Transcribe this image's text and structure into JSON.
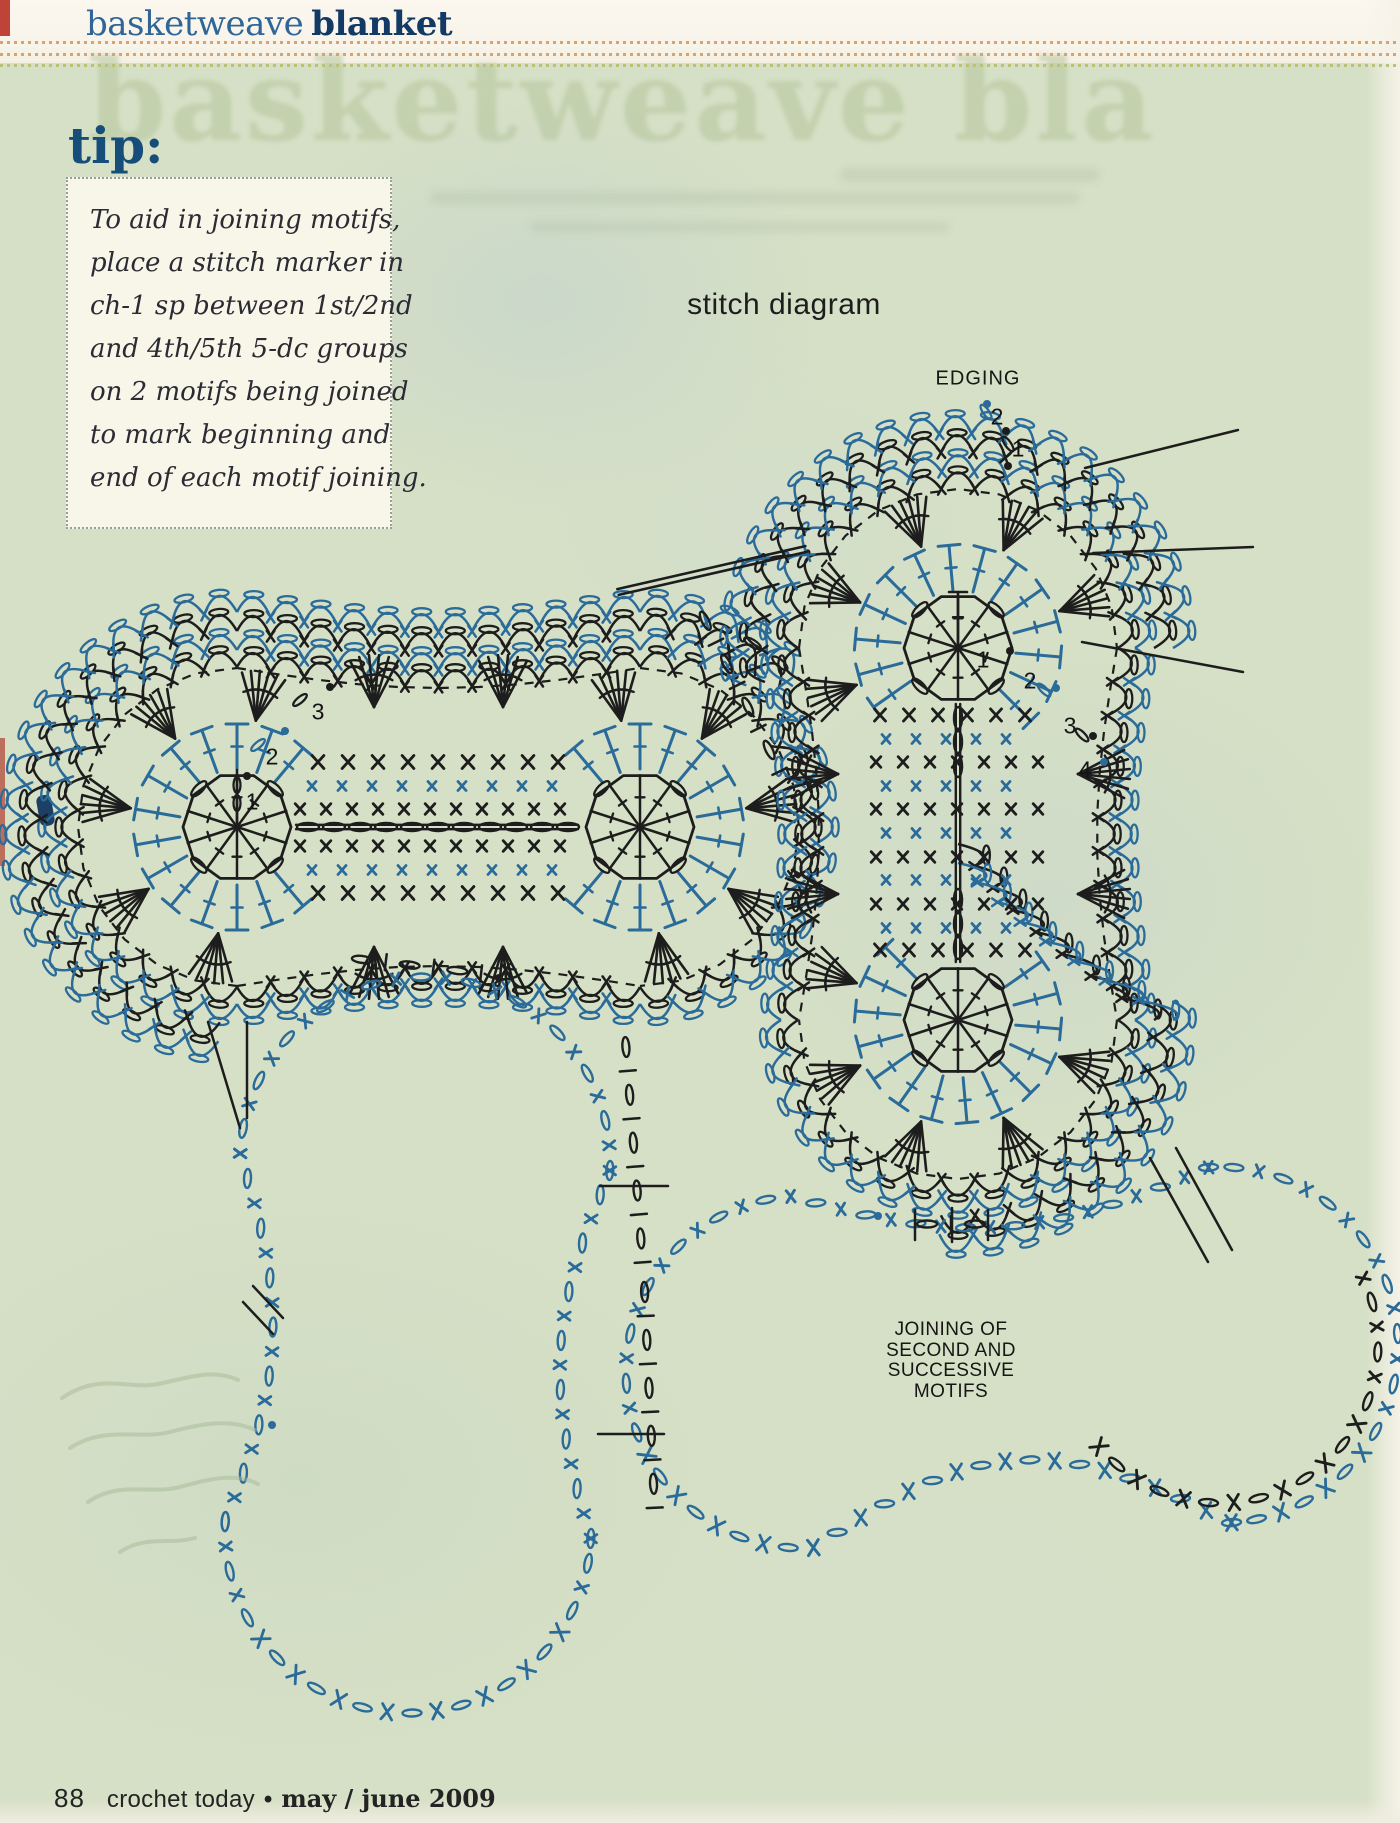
{
  "header": {
    "title_light": "basketweave",
    "title_bold": "blanket"
  },
  "tip": {
    "heading": "tip:",
    "lines": [
      "To aid in joining motifs,",
      "place a stitch marker in",
      "ch-1 sp between 1st/2nd",
      "and 4th/5th 5-dc groups",
      "on 2 motifs being joined",
      "to mark beginning and",
      "end of each motif joining."
    ]
  },
  "diagram": {
    "title": "stitch diagram",
    "title_pos": {
      "x": 784,
      "y": 305
    },
    "edging": {
      "label": "EDGING",
      "x": 978,
      "y": 379
    },
    "joining_note": {
      "lines": [
        "JOINING OF",
        "SECOND AND",
        "SUCCESSIVE",
        "MOTIFS"
      ],
      "x": 951,
      "y": 1320
    },
    "labels": [
      {
        "t": "1",
        "x": 252,
        "y": 802
      },
      {
        "t": "2",
        "x": 272,
        "y": 757
      },
      {
        "t": "3",
        "x": 318,
        "y": 712
      },
      {
        "t": "1",
        "x": 983,
        "y": 660
      },
      {
        "t": "2",
        "x": 1030,
        "y": 681
      },
      {
        "t": "3",
        "x": 1070,
        "y": 726
      },
      {
        "t": "4",
        "x": 1085,
        "y": 770
      },
      {
        "t": "2",
        "x": 997,
        "y": 417
      },
      {
        "t": "1",
        "x": 1018,
        "y": 449
      }
    ],
    "dots": [
      [
        247,
        776,
        "k"
      ],
      [
        285,
        731,
        "b"
      ],
      [
        330,
        687,
        "k"
      ],
      [
        1010,
        651,
        "k"
      ],
      [
        1056,
        688,
        "b"
      ],
      [
        1093,
        736,
        "k"
      ],
      [
        1104,
        762,
        "b"
      ],
      [
        987,
        404,
        "b"
      ],
      [
        1006,
        431,
        "k"
      ],
      [
        1008,
        466,
        "k"
      ],
      [
        499,
        978,
        "k"
      ],
      [
        272,
        1425,
        "b"
      ],
      [
        878,
        1216,
        "b"
      ]
    ],
    "marker_ovals": [
      [
        986,
        412,
        55,
        "b"
      ],
      [
        1008,
        444,
        55,
        "k"
      ],
      [
        1044,
        690,
        45,
        "b"
      ],
      [
        1082,
        735,
        45,
        "k"
      ],
      [
        258,
        745,
        -40,
        "b"
      ],
      [
        300,
        700,
        -40,
        "k"
      ]
    ]
  },
  "geometry": {
    "radii": {
      "core": 54,
      "t1": 58,
      "t2": 103,
      "fan_in": 108,
      "fan_out": 158,
      "dash": 159,
      "row1": 160,
      "row2": 177,
      "row3": 196,
      "row4": 215,
      "bump": 16
    },
    "motifs": [
      {
        "name": "first-motif",
        "A": [
          237,
          827
        ],
        "B": [
          640,
          827
        ],
        "axis": "h",
        "fansA": [
          100,
          145,
          190,
          235,
          280
        ],
        "fansB": [
          260,
          305,
          350,
          395,
          440
        ],
        "waist_fans": [
          [
            374,
            707,
            270
          ],
          [
            503,
            707,
            270
          ],
          [
            374,
            947,
            90
          ],
          [
            503,
            947,
            90
          ]
        ],
        "edging": {
          "arcA": [
            95,
            270
          ],
          "seg": "top",
          "arcB": [
            270,
            315
          ]
        },
        "tA": [
          50,
          310
        ],
        "tB": [
          230,
          490
        ],
        "stemA": {
          "dir": 270,
          "len": 57,
          "ovals": [
            24,
            42
          ],
          "tee": false
        },
        "grid": {
          "rows": [
            [
              762,
              "k",
              16,
              30,
              318,
              558
            ],
            [
              786,
              "b",
              11,
              30,
              312,
              570
            ],
            [
              809,
              "k",
              13,
              26,
              300,
              576
            ],
            [
              846,
              "k",
              13,
              26,
              300,
              576
            ],
            [
              870,
              "b",
              11,
              30,
              312,
              570
            ],
            [
              893,
              "k",
              16,
              30,
              318,
              558
            ]
          ],
          "axis": {
            "x0": 296,
            "y0": 827,
            "x1": 578,
            "y1": 827,
            "ovals": "full"
          }
        }
      },
      {
        "name": "second-motif",
        "A": [
          958,
          648
        ],
        "B": [
          958,
          1020
        ],
        "axis": "v",
        "fansA": [
          160,
          205,
          250,
          295,
          340
        ],
        "fansB": [
          20,
          65,
          110,
          155,
          200
        ],
        "waist_fans": [
          [
            838,
            774,
            180
          ],
          [
            838,
            894,
            180
          ],
          [
            1078,
            774,
            0
          ],
          [
            1078,
            894,
            0
          ]
        ],
        "edging": {
          "arcA": [
            170,
            360
          ],
          "seg": "right",
          "arcB": [
            355,
            455
          ]
        },
        "tA": [
          145,
          405
        ],
        "tB": [
          -35,
          225
        ],
        "stemA": {
          "dir": 270,
          "len": 56,
          "ovals": [],
          "tee": true
        },
        "grid": {
          "rows": [
            [
              715,
              "k",
              15,
              29,
              880,
              1040
            ],
            [
              739,
              "b",
              11,
              30,
              886,
              1032
            ],
            [
              762,
              "k",
              13,
              27,
              876,
              1042
            ],
            [
              786,
              "b",
              11,
              30,
              886,
              1032
            ],
            [
              809,
              "k",
              13,
              27,
              876,
              1042
            ],
            [
              833,
              "b",
              11,
              30,
              886,
              1032
            ],
            [
              857,
              "k",
              13,
              27,
              876,
              1042
            ],
            [
              880,
              "b",
              11,
              30,
              886,
              1032
            ],
            [
              904,
              "k",
              13,
              27,
              876,
              1042
            ],
            [
              928,
              "b",
              11,
              30,
              886,
              1032
            ],
            [
              950,
              "k",
              15,
              29,
              880,
              1040
            ]
          ],
          "axis": {
            "x0": 958,
            "y0": 704,
            "x1": 958,
            "y1": 962,
            "ovals": "ends"
          }
        }
      }
    ],
    "outlines": [
      {
        "name": "third-motif-outline",
        "A": [
          425,
          1162
        ],
        "rA": 185,
        "B": [
          408,
          1530
        ],
        "rB": 183,
        "dip1": 40,
        "dip2": 40
      },
      {
        "name": "fourth-motif-outline",
        "A": [
          802,
          1372
        ],
        "rA": 176,
        "B": [
          1220,
          1345
        ],
        "rB": 178,
        "dip1": 75,
        "dip2": 45,
        "black_arc": [
          -25,
          140
        ]
      }
    ],
    "seams": [
      {
        "type": "dline",
        "a": [
          618,
          592
        ],
        "b": [
          806,
          549
        ]
      },
      {
        "type": "chain",
        "pts": [
          [
            700,
            610
          ],
          [
            780,
            772
          ]
        ]
      },
      {
        "type": "line",
        "a": [
          208,
          1022
        ],
        "b": [
          240,
          1128
        ]
      },
      {
        "type": "line",
        "a": [
          247,
          1022
        ],
        "b": [
          247,
          1118
        ]
      },
      {
        "type": "chain",
        "pts": [
          [
            350,
            958
          ],
          [
            495,
            975
          ]
        ]
      },
      {
        "type": "chain",
        "pts": [
          [
            625,
            1035
          ],
          [
            644,
            1280
          ],
          [
            655,
            1515
          ]
        ]
      },
      {
        "type": "line",
        "a": [
          600,
          1186
        ],
        "b": [
          668,
          1186
        ]
      },
      {
        "type": "line",
        "a": [
          598,
          1434
        ],
        "b": [
          664,
          1434
        ]
      },
      {
        "type": "chain",
        "pts": [
          [
            915,
            1224
          ],
          [
            990,
            1224
          ]
        ]
      },
      {
        "type": "line",
        "a": [
          915,
          1210
        ],
        "b": [
          915,
          1240
        ]
      },
      {
        "type": "line",
        "a": [
          952,
          1208
        ],
        "b": [
          952,
          1242
        ]
      },
      {
        "type": "line",
        "a": [
          988,
          1210
        ],
        "b": [
          988,
          1240
        ]
      },
      {
        "type": "line",
        "a": [
          1150,
          1158
        ],
        "b": [
          1208,
          1262
        ]
      },
      {
        "type": "line",
        "a": [
          1176,
          1148
        ],
        "b": [
          1232,
          1250
        ]
      },
      {
        "type": "line",
        "a": [
          1085,
          468
        ],
        "b": [
          1238,
          430
        ]
      },
      {
        "type": "line",
        "a": [
          1093,
          553
        ],
        "b": [
          1253,
          547
        ]
      },
      {
        "type": "line",
        "a": [
          1082,
          642
        ],
        "b": [
          1243,
          672
        ]
      },
      {
        "type": "line",
        "a": [
          253,
          1286
        ],
        "b": [
          283,
          1318
        ]
      },
      {
        "type": "line",
        "a": [
          243,
          1302
        ],
        "b": [
          273,
          1334
        ]
      }
    ]
  },
  "footer": {
    "page_number": "88",
    "magazine": "crochet today",
    "separator": "•",
    "issue": "may / june 2009"
  },
  "colors": {
    "stroke_black": "#1d1d1d",
    "stroke_blue": "#2a6b99",
    "page_green": "#d6e0c6",
    "paper_white": "#faf7ee",
    "title_blue": "#2f6697",
    "title_navy": "#123a64",
    "tip_navy": "#164e79",
    "tip_bg": "#f8f5e9",
    "tip_text": "#2b2b33",
    "dot_orange": "#d8a273",
    "dot_olive": "#bcc178",
    "red_mark": "#bf4437",
    "ghost": "#aec194",
    "handwriting": "#a6b996"
  }
}
